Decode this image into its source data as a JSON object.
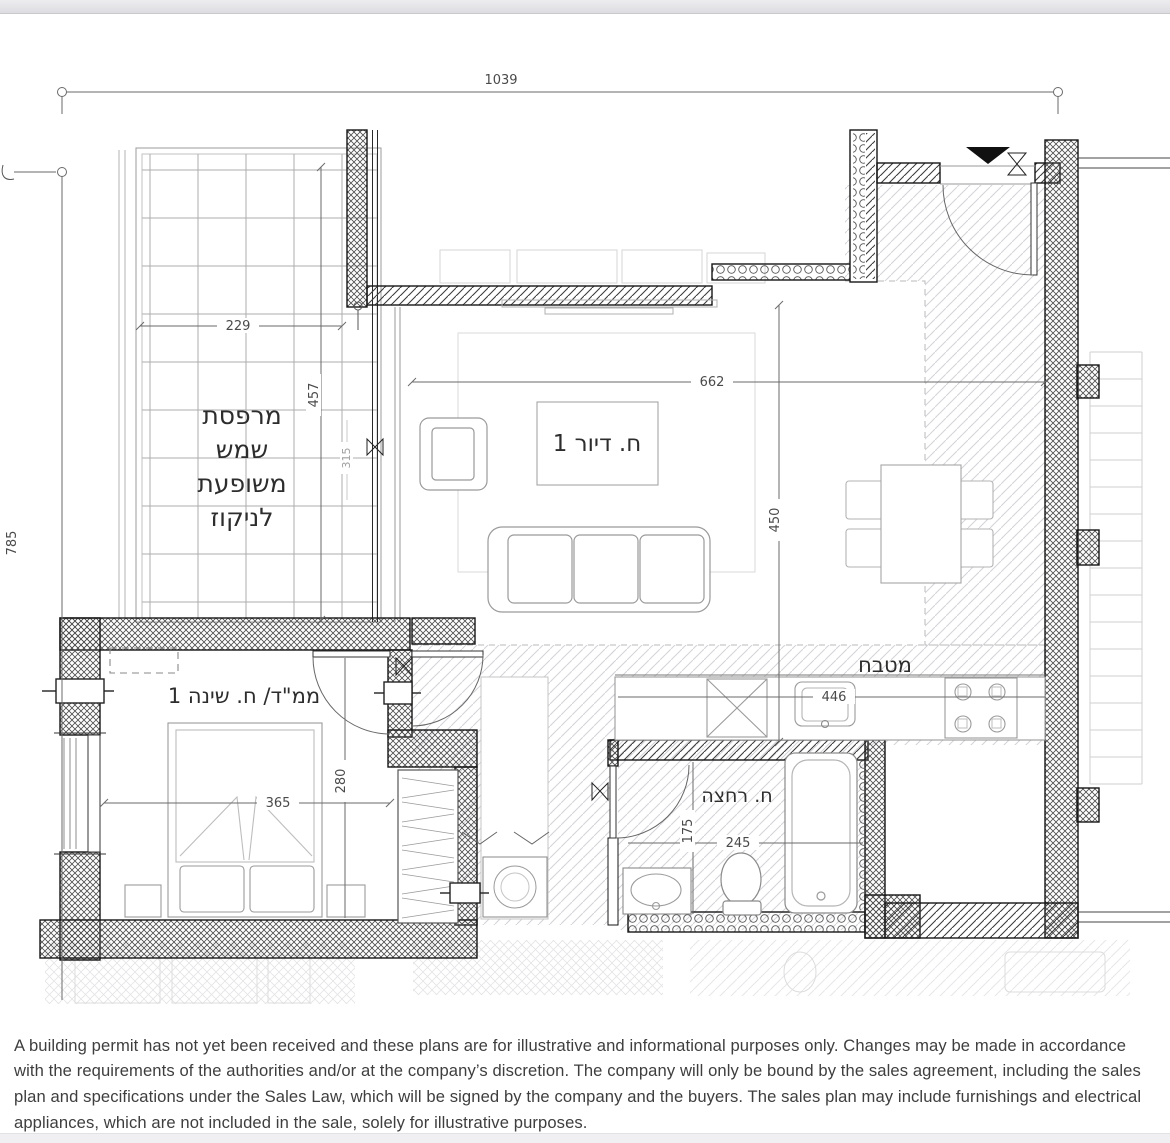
{
  "colors": {
    "background": "#ffffff",
    "chrome_bar": "#e7e7eb",
    "wall_line": "#161616",
    "text": "#3e3e3e"
  },
  "plan": {
    "dimensions": {
      "total_width": "1039",
      "total_depth": "785",
      "balcony_width": "229",
      "balcony_depth": "457",
      "balcony_glazing": "315",
      "living_width": "662",
      "living_depth": "450",
      "kitchen_counter": "446",
      "bedroom_width": "365",
      "bedroom_depth": "280",
      "bathroom_depth": "175",
      "bathroom_width": "245"
    },
    "rooms": {
      "balcony": {
        "line1": "מרפסת",
        "line2": "שמש",
        "line3": "משופעת",
        "line4": "לניקוז"
      },
      "living": {
        "label": "ח. דיור 1"
      },
      "kitchen": {
        "label": "מטבח"
      },
      "bedroom": {
        "label": "ממ\"ד/ ח. שינה 1"
      },
      "bathroom": {
        "label": "ח. רחצה"
      }
    }
  },
  "disclaimer": {
    "text": "A building permit has not yet been received and these plans are for illustrative and informational purposes only. Changes may be made in accordance with the requirements of the authorities and/or at the company’s discretion. The company will only be bound by the sales agreement, including the sales plan and specifications under the Sales Law, which will be signed by the company and the buyers. The sales plan may include furnishings and electrical appliances, which are not included in the sale, solely for illustrative purposes."
  }
}
